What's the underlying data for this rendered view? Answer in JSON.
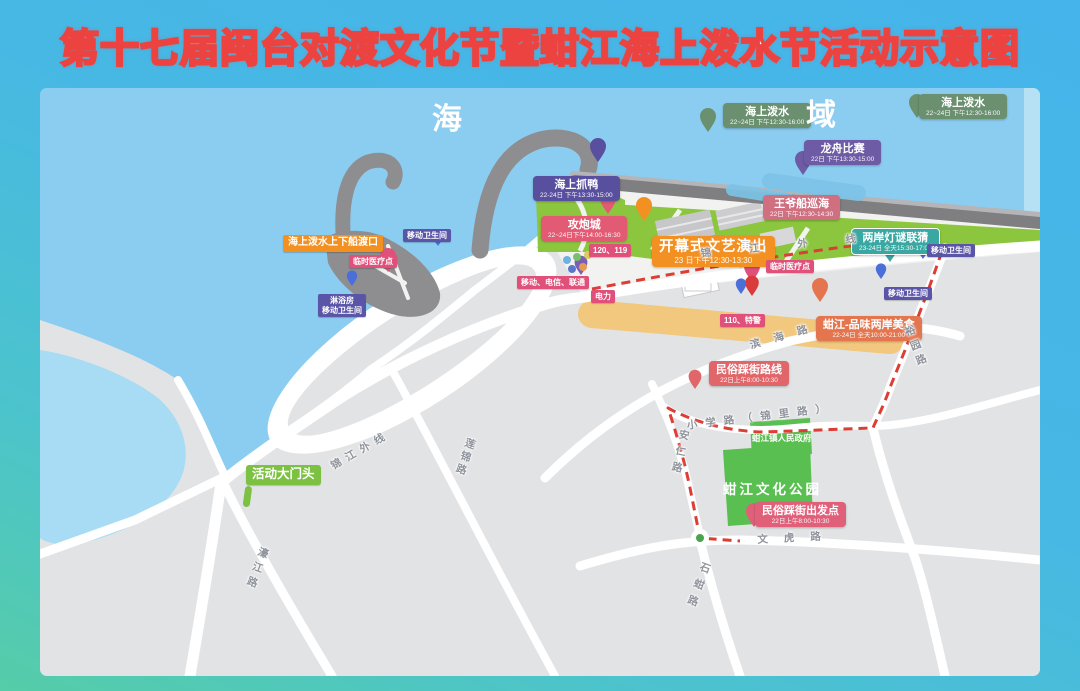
{
  "title": "第十七届闽台对渡文化节暨蚶江海上泼水节活动示意图",
  "sea_area": {
    "left_char": "海",
    "right_char": "域"
  },
  "colors": {
    "title_stroke": "#ec4340",
    "sea": "#8bcdf0",
    "land": "#e2e3e5",
    "shore_green": "#8cc63e",
    "park_green": "#5abf51",
    "route_red": "#dc3e36",
    "food_street_tan": "#f2c87e",
    "pier_gray": "#8e8e90"
  },
  "events": [
    {
      "name": "海上泼水",
      "time": "22~24日 下午12:30-16:00",
      "style": "green",
      "x": 723,
      "y": 103
    },
    {
      "name": "海上泼水",
      "time": "22~24日 下午12:30-16:00",
      "style": "green",
      "x": 919,
      "y": 94
    },
    {
      "name": "龙舟比赛",
      "time": "22日 下午13:30-15:00",
      "style": "purple",
      "x": 804,
      "y": 140
    },
    {
      "name": "王爷船巡海",
      "time": "22日 下午12:30-14:30",
      "style": "rose",
      "x": 763,
      "y": 195
    },
    {
      "name": "海上抓鸭",
      "time": "22-24日 下午13:30-15:00",
      "style": "deep-purple",
      "x": 533,
      "y": 176
    },
    {
      "name": "攻炮城",
      "time": "22~24日下午14:00-16:30",
      "style": "red",
      "x": 541,
      "y": 216
    },
    {
      "name": "开幕式文艺演出",
      "time": "23 日下午12:30-13:30",
      "style": "orange big",
      "x": 652,
      "y": 236
    },
    {
      "name": "两岸灯谜联猜",
      "time": "23-24日 全天15:30-17:00",
      "style": "teal",
      "x": 851,
      "y": 228
    },
    {
      "name": "蚶江-品味两岸美食",
      "time": "22-24日 全天10:00-21:00",
      "style": "orange-red",
      "x": 816,
      "y": 316
    },
    {
      "name": "民俗踩街路线",
      "time": "22日上午8:00-10:30",
      "style": "salmon",
      "x": 709,
      "y": 361
    },
    {
      "name": "民俗踩街出发点",
      "time": "22日上午8:00-10:30",
      "style": "pinkish",
      "x": 755,
      "y": 502
    }
  ],
  "facilities": [
    {
      "text": "海上泼水上下船渡口",
      "style": "orange-tag",
      "x": 283,
      "y": 235
    },
    {
      "text": "临时医疗点",
      "style": "pink-tag",
      "x": 349,
      "y": 255
    },
    {
      "text": "临时医疗点",
      "style": "pink-tag",
      "x": 766,
      "y": 260
    },
    {
      "text": "移动卫生间",
      "style": "violet-tag",
      "x": 403,
      "y": 229
    },
    {
      "text": "淋浴房\n移动卫生间",
      "style": "violet-tag",
      "x": 318,
      "y": 294
    },
    {
      "text": "移动卫生间",
      "style": "violet-tag",
      "x": 927,
      "y": 244
    },
    {
      "text": "移动卫生间",
      "style": "violet-tag",
      "x": 884,
      "y": 287
    },
    {
      "text": "120、119",
      "style": "pink-tag",
      "x": 589,
      "y": 244
    },
    {
      "text": "移动、电信、联通",
      "style": "pink-tag",
      "x": 517,
      "y": 276
    },
    {
      "text": "电力",
      "style": "pink-tag",
      "x": 591,
      "y": 290
    },
    {
      "text": "110、特警",
      "style": "pink-tag",
      "x": 720,
      "y": 314
    },
    {
      "text": "活动大门头",
      "style": "gate-tag",
      "x": 246,
      "y": 465
    }
  ],
  "places": [
    {
      "text": "蚶江文化公园",
      "style": "park-name",
      "x": 723,
      "y": 478
    },
    {
      "text": "蚶江镇人民政府",
      "style": "gov-name",
      "x": 752,
      "y": 432
    },
    {
      "text": "海",
      "style": "sea-char",
      "x": 432,
      "y": 94
    },
    {
      "text": "域",
      "style": "sea-char",
      "x": 806,
      "y": 90
    }
  ],
  "roads": [
    {
      "name": "锦江外线",
      "x": 700,
      "y": 246,
      "rot": -5.5,
      "spacing": 38,
      "vertical": false
    },
    {
      "name": "锦江外线",
      "x": 328,
      "y": 460,
      "rot": -30,
      "spacing": 6,
      "vertical": false
    },
    {
      "name": "滨海路",
      "x": 748,
      "y": 338,
      "rot": -16,
      "spacing": 14,
      "vertical": false
    },
    {
      "name": "小学路（锦里路）",
      "x": 686,
      "y": 418,
      "rot": -7,
      "spacing": 8,
      "vertical": false
    },
    {
      "name": "安仁路",
      "x": 678,
      "y": 428,
      "rot": 12,
      "spacing": 6,
      "vertical": true
    },
    {
      "name": "文虎路",
      "x": 757,
      "y": 532,
      "rot": -3,
      "spacing": 16,
      "vertical": false
    },
    {
      "name": "石蚶路",
      "x": 700,
      "y": 560,
      "rot": 20,
      "spacing": 7,
      "vertical": true
    },
    {
      "name": "濠江路",
      "x": 258,
      "y": 545,
      "rot": 20,
      "spacing": 5,
      "vertical": true
    },
    {
      "name": "莲锦路",
      "x": 465,
      "y": 436,
      "rot": 19,
      "spacing": 3,
      "vertical": true
    },
    {
      "name": "裕园路",
      "x": 901,
      "y": 328,
      "rot": -21,
      "spacing": 5,
      "vertical": true
    }
  ]
}
